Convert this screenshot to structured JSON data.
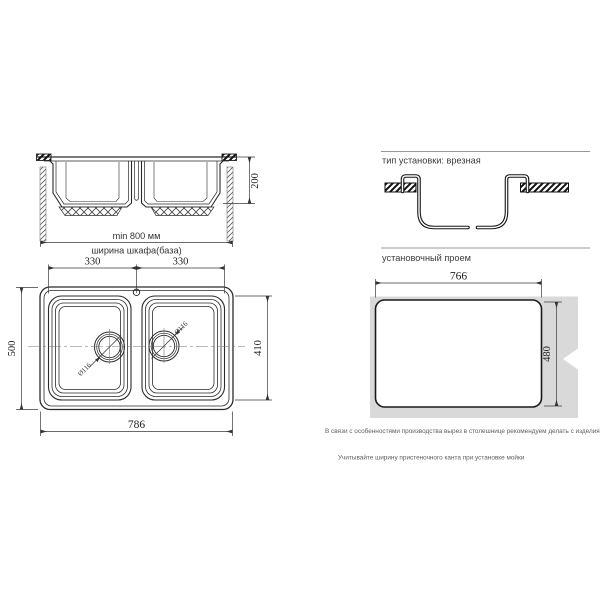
{
  "side_view": {
    "depth": "200",
    "min_width": "min 800 мм",
    "cabinet_width": "ширина шкафа(база)"
  },
  "top_view": {
    "left_bowl_width": "330",
    "right_bowl_width": "330",
    "overall_depth": "500",
    "bowl_depth": "410",
    "overall_width": "786",
    "left_drain_diameter": "Ø116",
    "right_drain_diameter": "Ø116"
  },
  "installation": {
    "type_heading": "тип установки: врезная",
    "opening_heading": "установочный проем",
    "opening_width": "766",
    "opening_height": "480"
  },
  "notes": {
    "production_note": "В связи с особенностями производства вырез в столешнице рекомендуем делать с изделия.",
    "edge_note": "Учитывайте ширину пристеночного канта при установке мойки"
  },
  "colors": {
    "line": "#2a2a2a",
    "dimension_line": "#3a3a3a",
    "countertop_fill": "#d9d9d9",
    "rule": "#999999",
    "note_text": "#5f5f5f"
  }
}
